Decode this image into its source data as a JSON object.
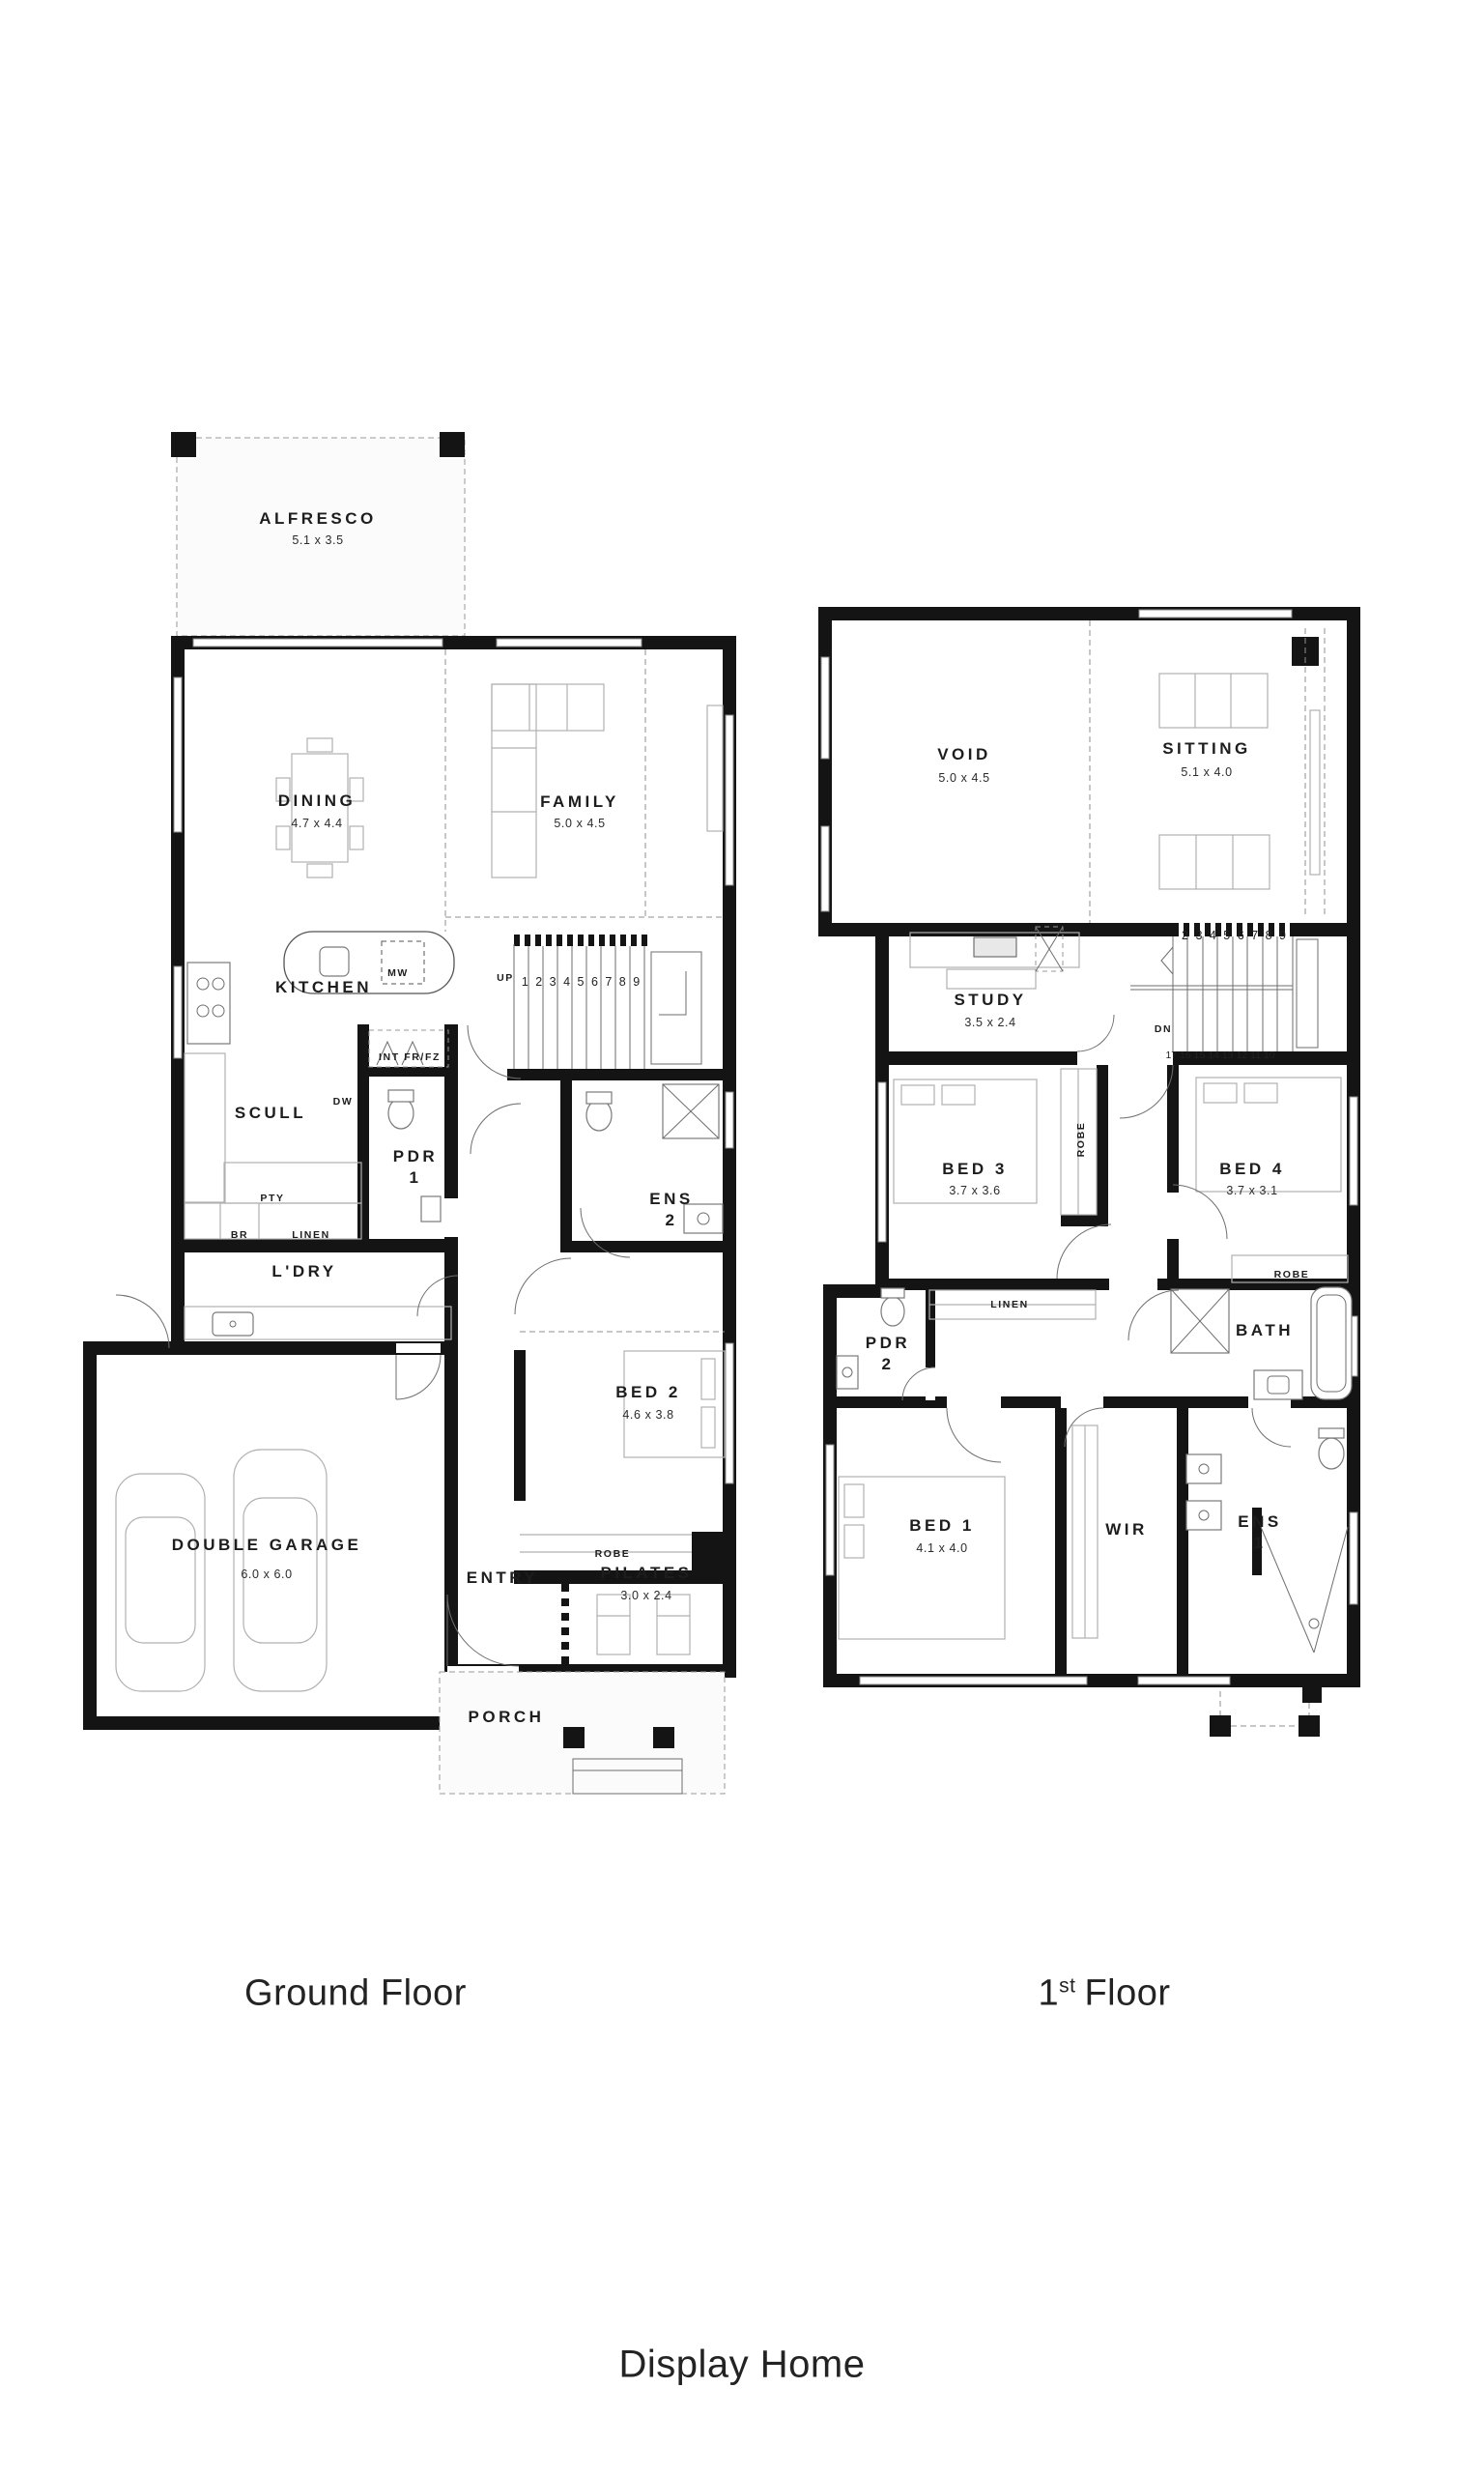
{
  "colors": {
    "wall": "#141414",
    "line": "#8a8a8a",
    "furniture": "#b0b0b0",
    "text": "#1d1d1d"
  },
  "ground": {
    "caption": "Ground Floor",
    "rooms": {
      "alfresco": {
        "name": "ALFRESCO",
        "dims": "5.1 x 3.5"
      },
      "dining": {
        "name": "DINING",
        "dims": "4.7 x 4.4"
      },
      "family": {
        "name": "FAMILY",
        "dims": "5.0 x 4.5"
      },
      "kitchen": {
        "name": "KITCHEN"
      },
      "scull": {
        "name": "SCULL"
      },
      "ldry": {
        "name": "L'DRY"
      },
      "pdr1": {
        "name": "PDR 1"
      },
      "ens2": {
        "name": "ENS 2"
      },
      "bed2": {
        "name": "BED 2",
        "dims": "4.6 x 3.8"
      },
      "garage": {
        "name": "DOUBLE GARAGE",
        "dims": "6.0 x 6.0"
      },
      "entry": {
        "name": "ENTRY"
      },
      "pilates": {
        "name": "PILATES",
        "dims": "3.0 x 2.4"
      },
      "porch": {
        "name": "PORCH"
      }
    },
    "labels": {
      "mw": "MW",
      "int_frfz": "INT FR/FZ",
      "dw": "DW",
      "pty": "PTY",
      "br": "BR",
      "linen": "LINEN",
      "robe": "ROBE",
      "up": "UP",
      "stair_numbers": "1 2 3 4 5 6 7 8 9"
    }
  },
  "first": {
    "caption": {
      "number": "1",
      "ordinal": "st",
      "word": "Floor"
    },
    "rooms": {
      "void": {
        "name": "VOID",
        "dims": "5.0 x 4.5"
      },
      "sitting": {
        "name": "SITTING",
        "dims": "5.1 x 4.0"
      },
      "study": {
        "name": "STUDY",
        "dims": "3.5 x 2.4"
      },
      "bed3": {
        "name": "BED 3",
        "dims": "3.7 x 3.6"
      },
      "bed4": {
        "name": "BED 4",
        "dims": "3.7 x 3.1"
      },
      "bed1": {
        "name": "BED 1",
        "dims": "4.1 x 4.0"
      },
      "wir": {
        "name": "WIR"
      },
      "ens1": {
        "name": "ENS 1"
      },
      "pdr2": {
        "name": "PDR 2"
      },
      "bath": {
        "name": "BATH"
      }
    },
    "labels": {
      "linen": "LINEN",
      "robe_bed3": "ROBE",
      "robe_bed4": "ROBE",
      "dn": "DN",
      "stair_numbers_top": "2 3 4 5 6 7 8 9",
      "stair_numbers_bottom": "17 16 15 14 13 12 11 10"
    }
  },
  "footer": {
    "caption": "Display Home"
  }
}
